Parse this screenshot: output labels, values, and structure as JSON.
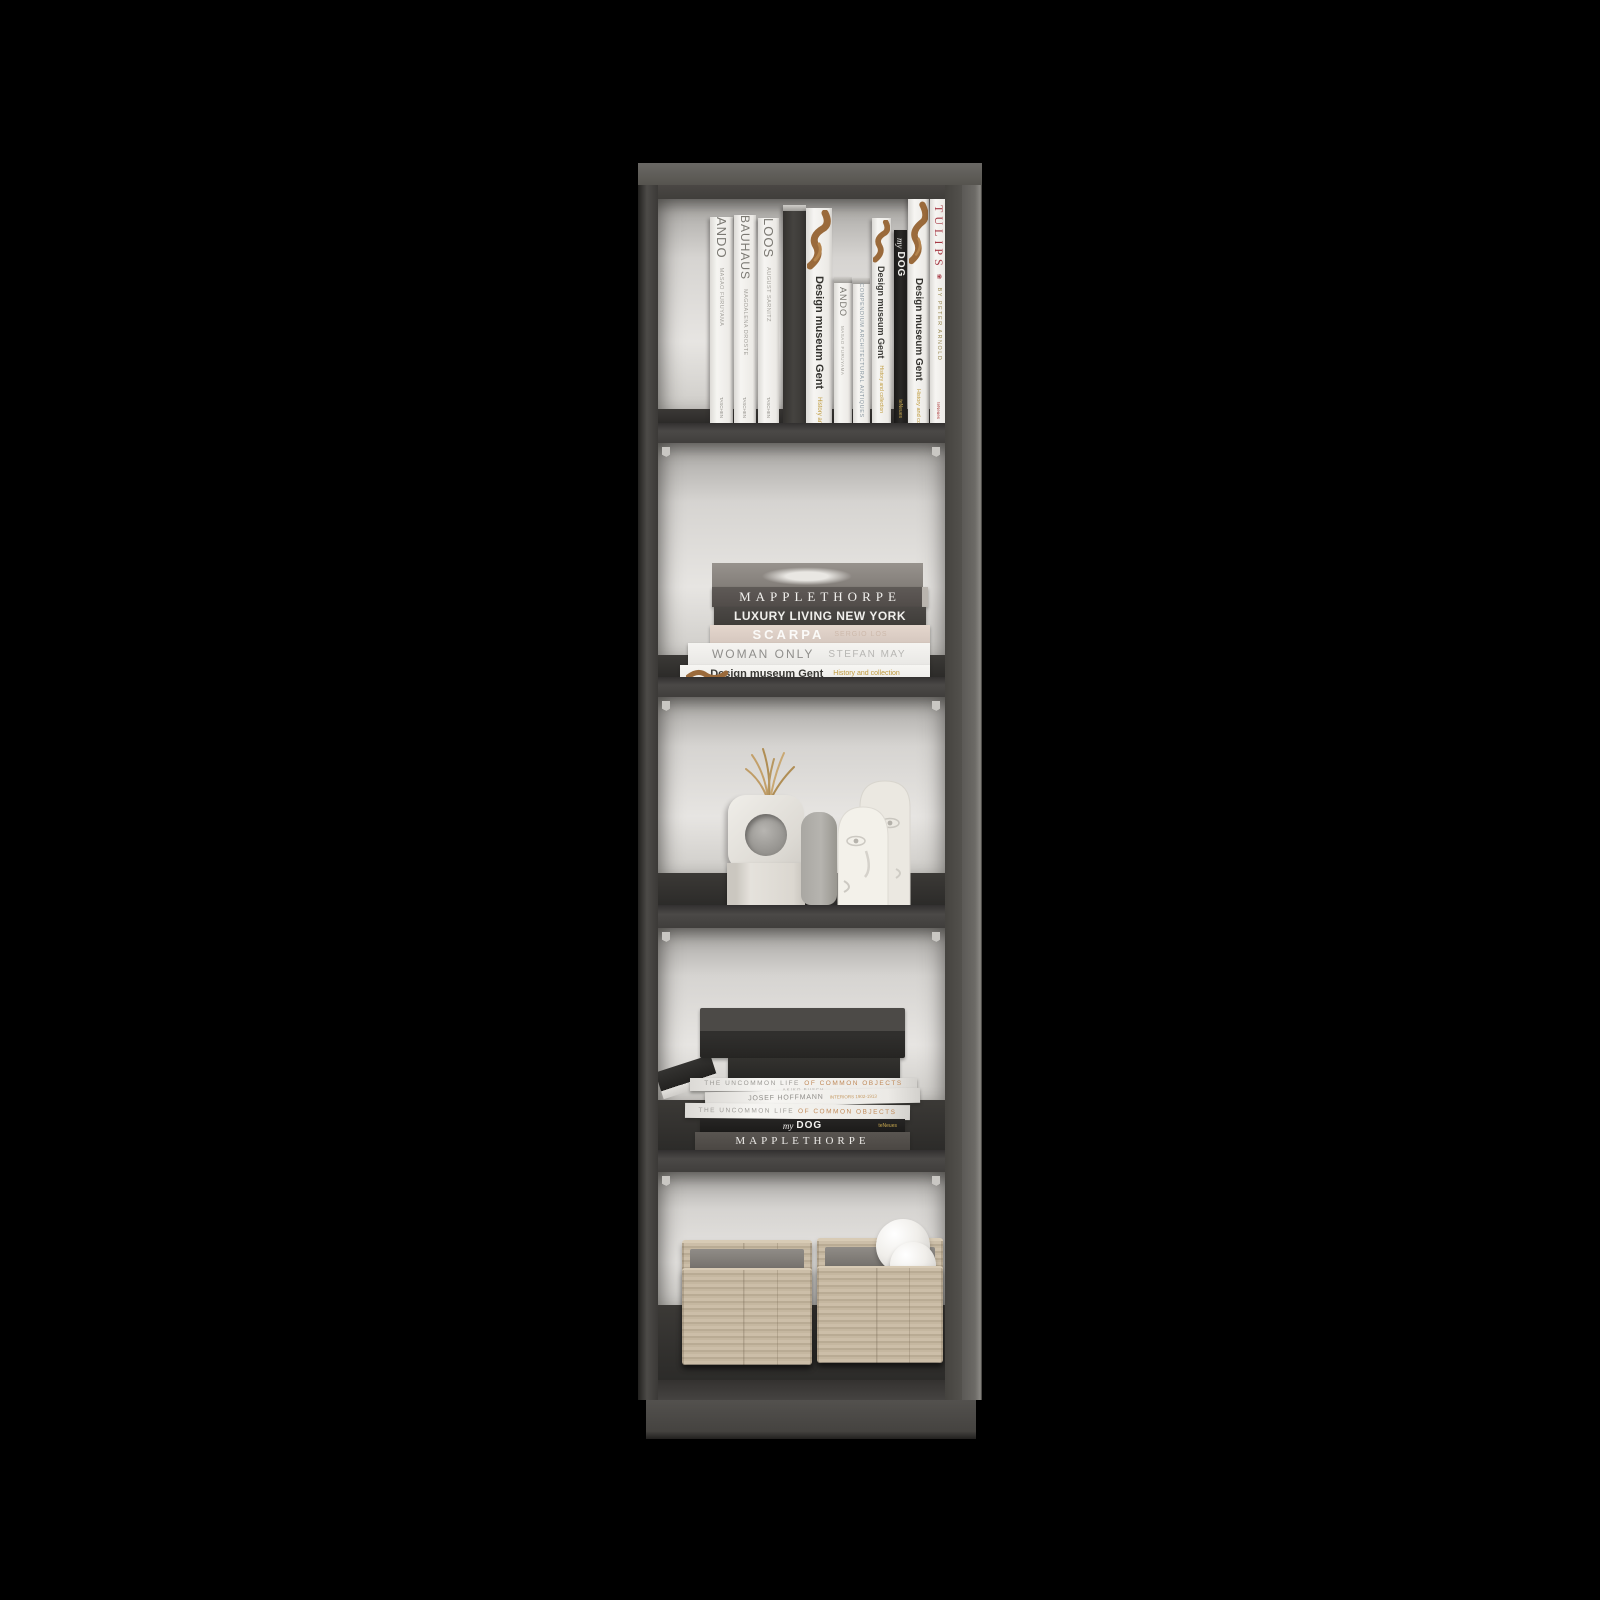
{
  "scene": {
    "description": "Product render of a tall narrow 5-shelf bookcase in smoke gray finish, styled with art books, ceramic decor and woven baskets, on a black background",
    "background_color": "#000000",
    "frame_color": "#4b4947",
    "shelf_color": "#35332f",
    "interior_color": "#dcdad7",
    "basket_color": "#c5b6a0",
    "accent_red": "#a63a45",
    "accent_gold": "#bf9a3c"
  },
  "icons": {
    "tulip": "❀"
  },
  "shelf1": {
    "books": [
      {
        "title": "ANDO",
        "author": "MASAO FURUYAMA",
        "publisher": "TASCHEN"
      },
      {
        "title": "BAUHAUS",
        "author": "MAGDALENA DROSTE",
        "publisher": "TASCHEN"
      },
      {
        "title": "LOOS",
        "author": "AUGUST SARNITZ",
        "publisher": "TASCHEN"
      },
      {
        "style": "plain dark hardcover"
      },
      {
        "title": "Design museum Gent",
        "subtitle": "History and collection"
      },
      {
        "title": "ANDO",
        "author": "MASAO FURUYAMA"
      },
      {
        "title": "COMPENDIUM ARCHITECTURAL ANTIQUES"
      },
      {
        "title": "Design museum Gent",
        "subtitle": "History and collection"
      },
      {
        "title_prefix": "my",
        "title_main": "DOG",
        "publisher": "teNeues"
      },
      {
        "title": "Design museum Gent",
        "subtitle": "History and collection"
      },
      {
        "title": "TULIPS",
        "author": "BY PETER ARNOLD",
        "publisher": "teNeues"
      }
    ]
  },
  "shelf2": {
    "stack": [
      {
        "title": "MAPPLETHORPE"
      },
      {
        "left": "LUXURY LIVING",
        "right": "NEW YORK"
      },
      {
        "title": "SCARPA",
        "subtitle": "SERGIO LOS"
      },
      {
        "title": "WOMAN ONLY",
        "subtitle": "STEFAN MAY"
      },
      {
        "title": "Design museum Gent",
        "subtitle": "History and collection"
      }
    ]
  },
  "shelf3": {
    "decor": [
      {
        "item": "dried grass sprig"
      },
      {
        "item": "white ring vase"
      },
      {
        "item": "white stone plinth"
      },
      {
        "item": "gray ceramic vase"
      },
      {
        "item": "abstract face sculpture"
      },
      {
        "item": "small ceramic sphere"
      }
    ]
  },
  "shelf4": {
    "stack": [
      {
        "style": "large dark hardcover"
      },
      {
        "style": "dark hardcover"
      },
      {
        "title": "THE UNCOMMON LIFE",
        "title2": "OF COMMON OBJECTS",
        "author": "AKIKO BUSCH"
      },
      {
        "title": "JOSEF HOFFMANN",
        "subtitle": "INTERIORS 1902-1913"
      },
      {
        "title": "THE UNCOMMON LIFE",
        "title2": "OF COMMON OBJECTS"
      },
      {
        "title_prefix": "my",
        "title_main": "DOG",
        "publisher": "teNeues"
      },
      {
        "title": "MAPPLETHORPE"
      }
    ]
  },
  "shelf5": {
    "baskets": [
      {
        "item": "woven storage basket"
      },
      {
        "item": "woven storage basket",
        "contents": "two white decorative spheres"
      }
    ]
  }
}
